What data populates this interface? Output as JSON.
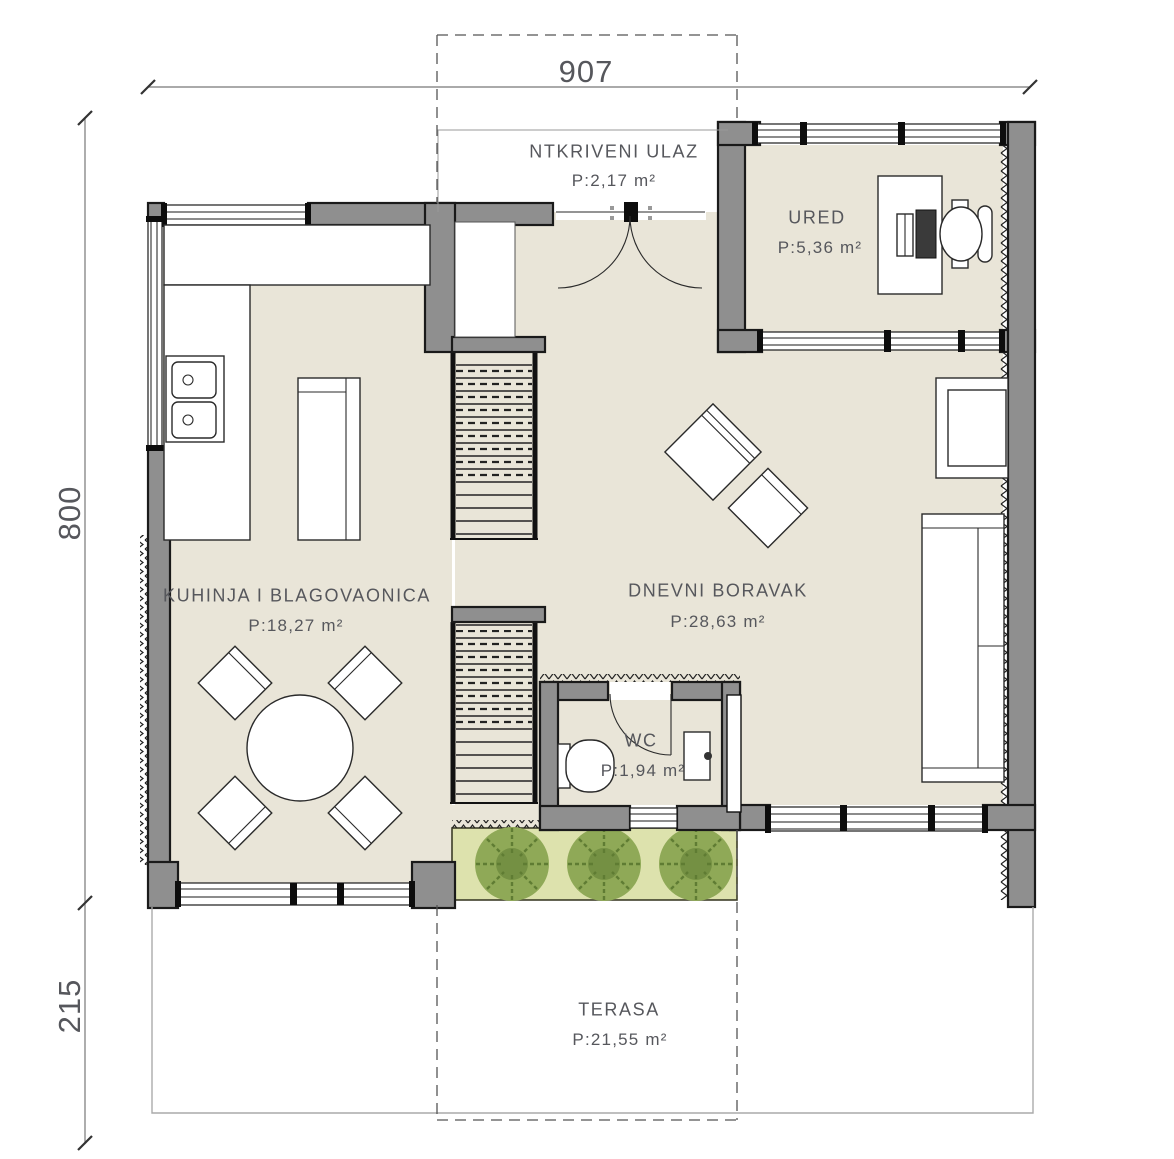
{
  "meta": {
    "type": "architectural-floor-plan"
  },
  "colors": {
    "floor": "#e9e5d8",
    "wall": "#8f8f8f",
    "line": "#1a1a1a",
    "planter": "#dde2ad",
    "bushL": "#8fa957",
    "bushD": "#5f7c33",
    "text": "#56575c"
  },
  "dimensions": {
    "width_top": "907",
    "height_left": "800",
    "height_left_lower": "215"
  },
  "rooms": [
    {
      "id": "entrance",
      "name": "NTKRIVENI ULAZ",
      "area": "P:2,17 m²"
    },
    {
      "id": "office",
      "name": "URED",
      "area": "P:5,36 m²"
    },
    {
      "id": "kitchen",
      "name": "KUHINJA I BLAGOVAONICA",
      "area": "P:18,27 m²"
    },
    {
      "id": "living",
      "name": "DNEVNI BORAVAK",
      "area": "P:28,63 m²"
    },
    {
      "id": "wc",
      "name": "WC",
      "area": "P:1,94 m²"
    },
    {
      "id": "terrace",
      "name": "TERASA",
      "area": "P:21,55 m²"
    }
  ]
}
